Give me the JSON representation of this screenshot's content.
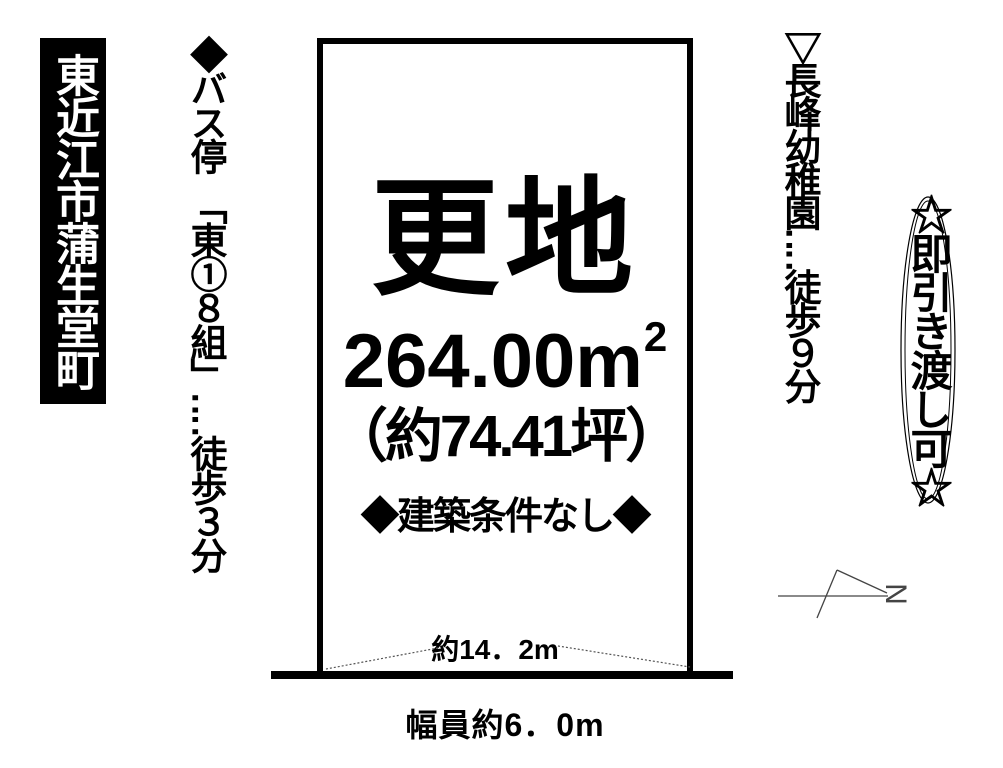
{
  "location": {
    "label": "東近江市蒲生堂町"
  },
  "bus_note": {
    "text": "◆バス停　「東①８組」‥‥徒歩３分"
  },
  "kindergarten_note": {
    "text": "▽長峰幼稚園‥‥徒歩９分"
  },
  "badge": {
    "text": "☆即引き渡し可☆"
  },
  "plot": {
    "status": "更地",
    "area_value": "264.00",
    "area_unit": "m",
    "area_exponent": "2",
    "area_tsubo": "（約74.41坪）",
    "conditions": "◆建築条件なし◆",
    "frontage": "約14．2m"
  },
  "road": {
    "width_label": "幅員約6．0m"
  },
  "compass": {
    "label": "N"
  },
  "colors": {
    "ink": "#000000",
    "paper": "#ffffff"
  }
}
